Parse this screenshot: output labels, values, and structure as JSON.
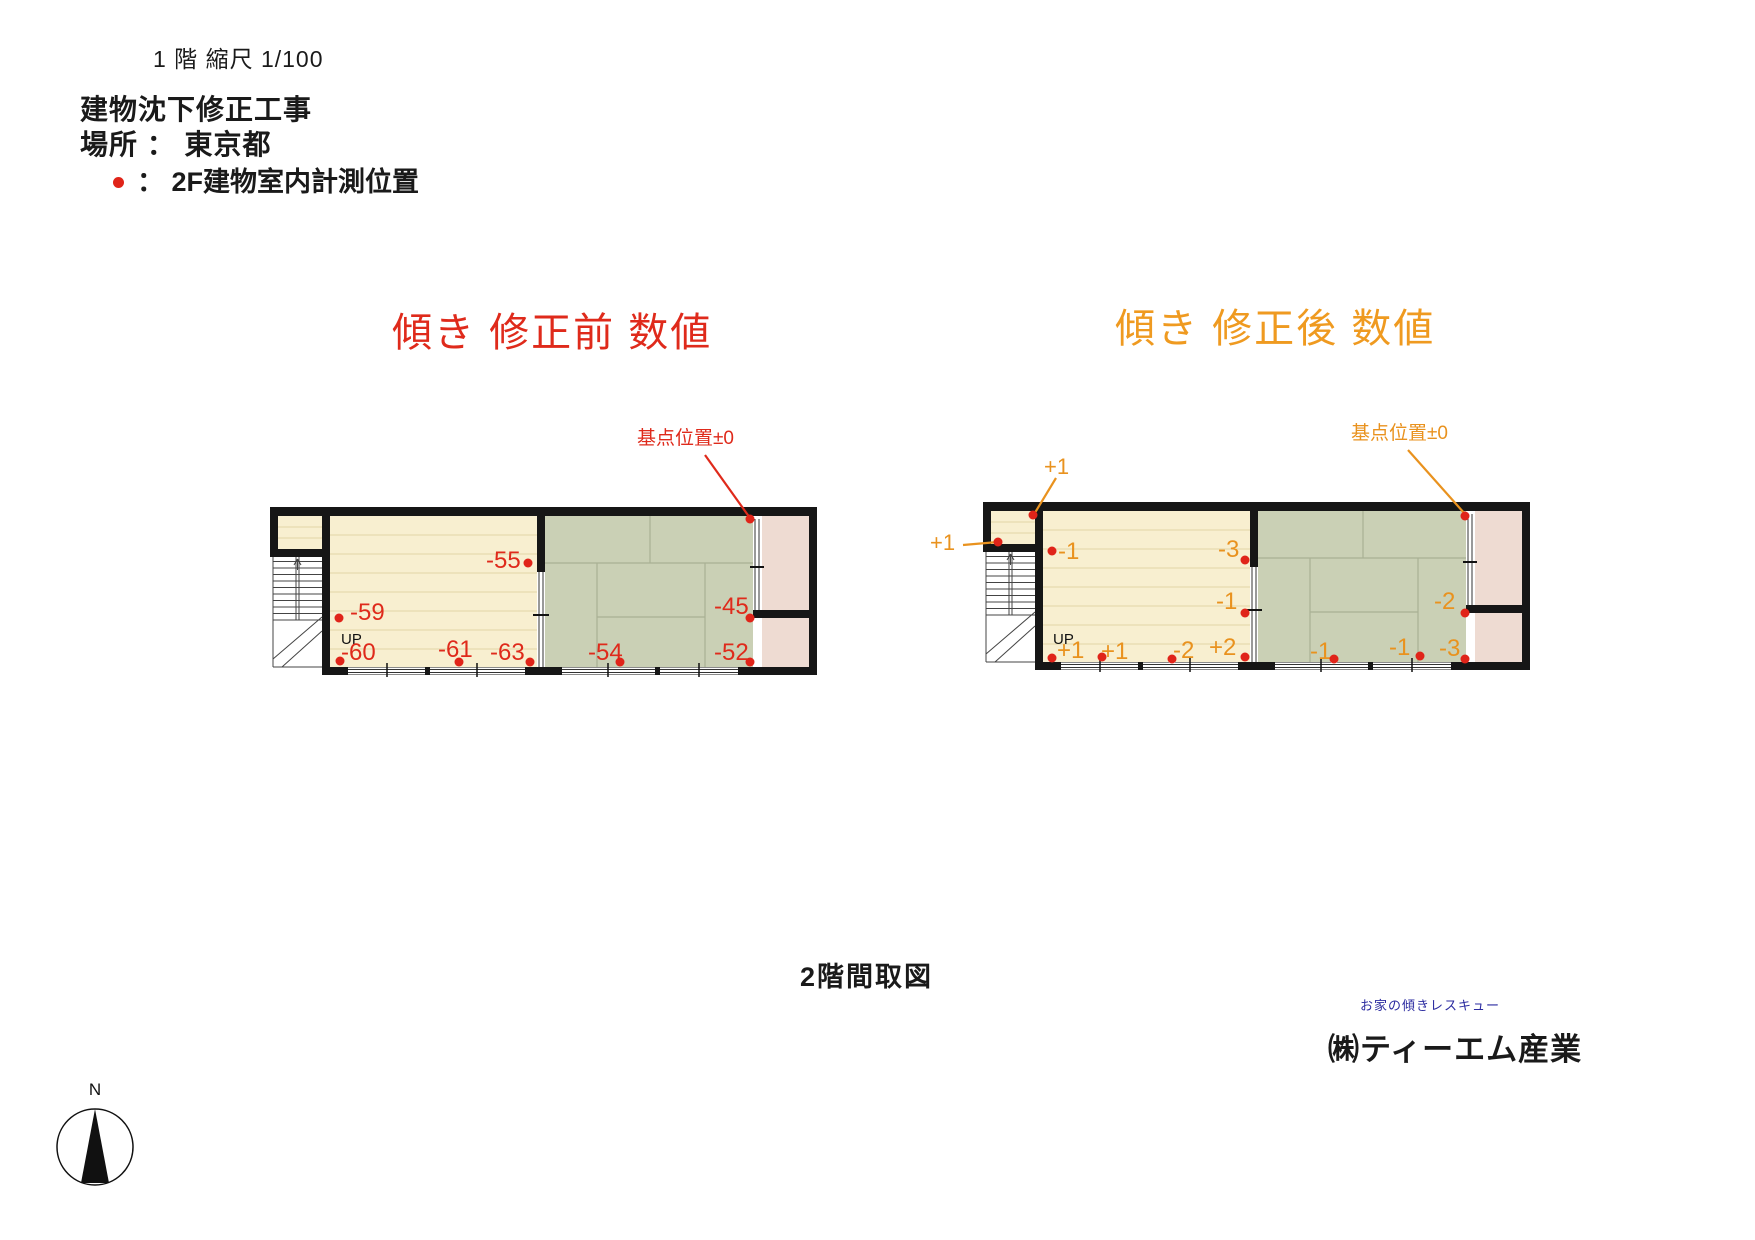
{
  "header": {
    "scale_note": "1 階 縮尺 1/100",
    "project_title": "建物沈下修正工事",
    "location": "場所 ： 東京都",
    "legend": "： 2F建物室内計測位置"
  },
  "before": {
    "title": "傾き 修正前 数値",
    "datum_label": "基点位置±0",
    "up_label": "UP",
    "values": [
      "-55",
      "-59",
      "-60",
      "-61",
      "-63",
      "-54",
      "-45",
      "-52"
    ]
  },
  "after": {
    "title": "傾き 修正後 数値",
    "datum_label": "基点位置±0",
    "up_label": "UP",
    "values": [
      "+1",
      "+1",
      "-1",
      "-3",
      "-1",
      "-2",
      "+1",
      "+1",
      "-2",
      "+2",
      "-1",
      "-1",
      "-3"
    ]
  },
  "footer": {
    "caption": "2階間取図",
    "brand": "お家の傾きレスキュー",
    "company": "㈱ティーエム産業"
  },
  "compass": {
    "north_label": "N"
  },
  "colors": {
    "before_accent": "#df2a1b",
    "after_accent": "#e9921e",
    "measurement_dot": "#e02419",
    "wood_floor": "#f8efd0",
    "tatami": "#cad0b5",
    "side_rooms": "#eedbd2",
    "walls": "#161616"
  }
}
